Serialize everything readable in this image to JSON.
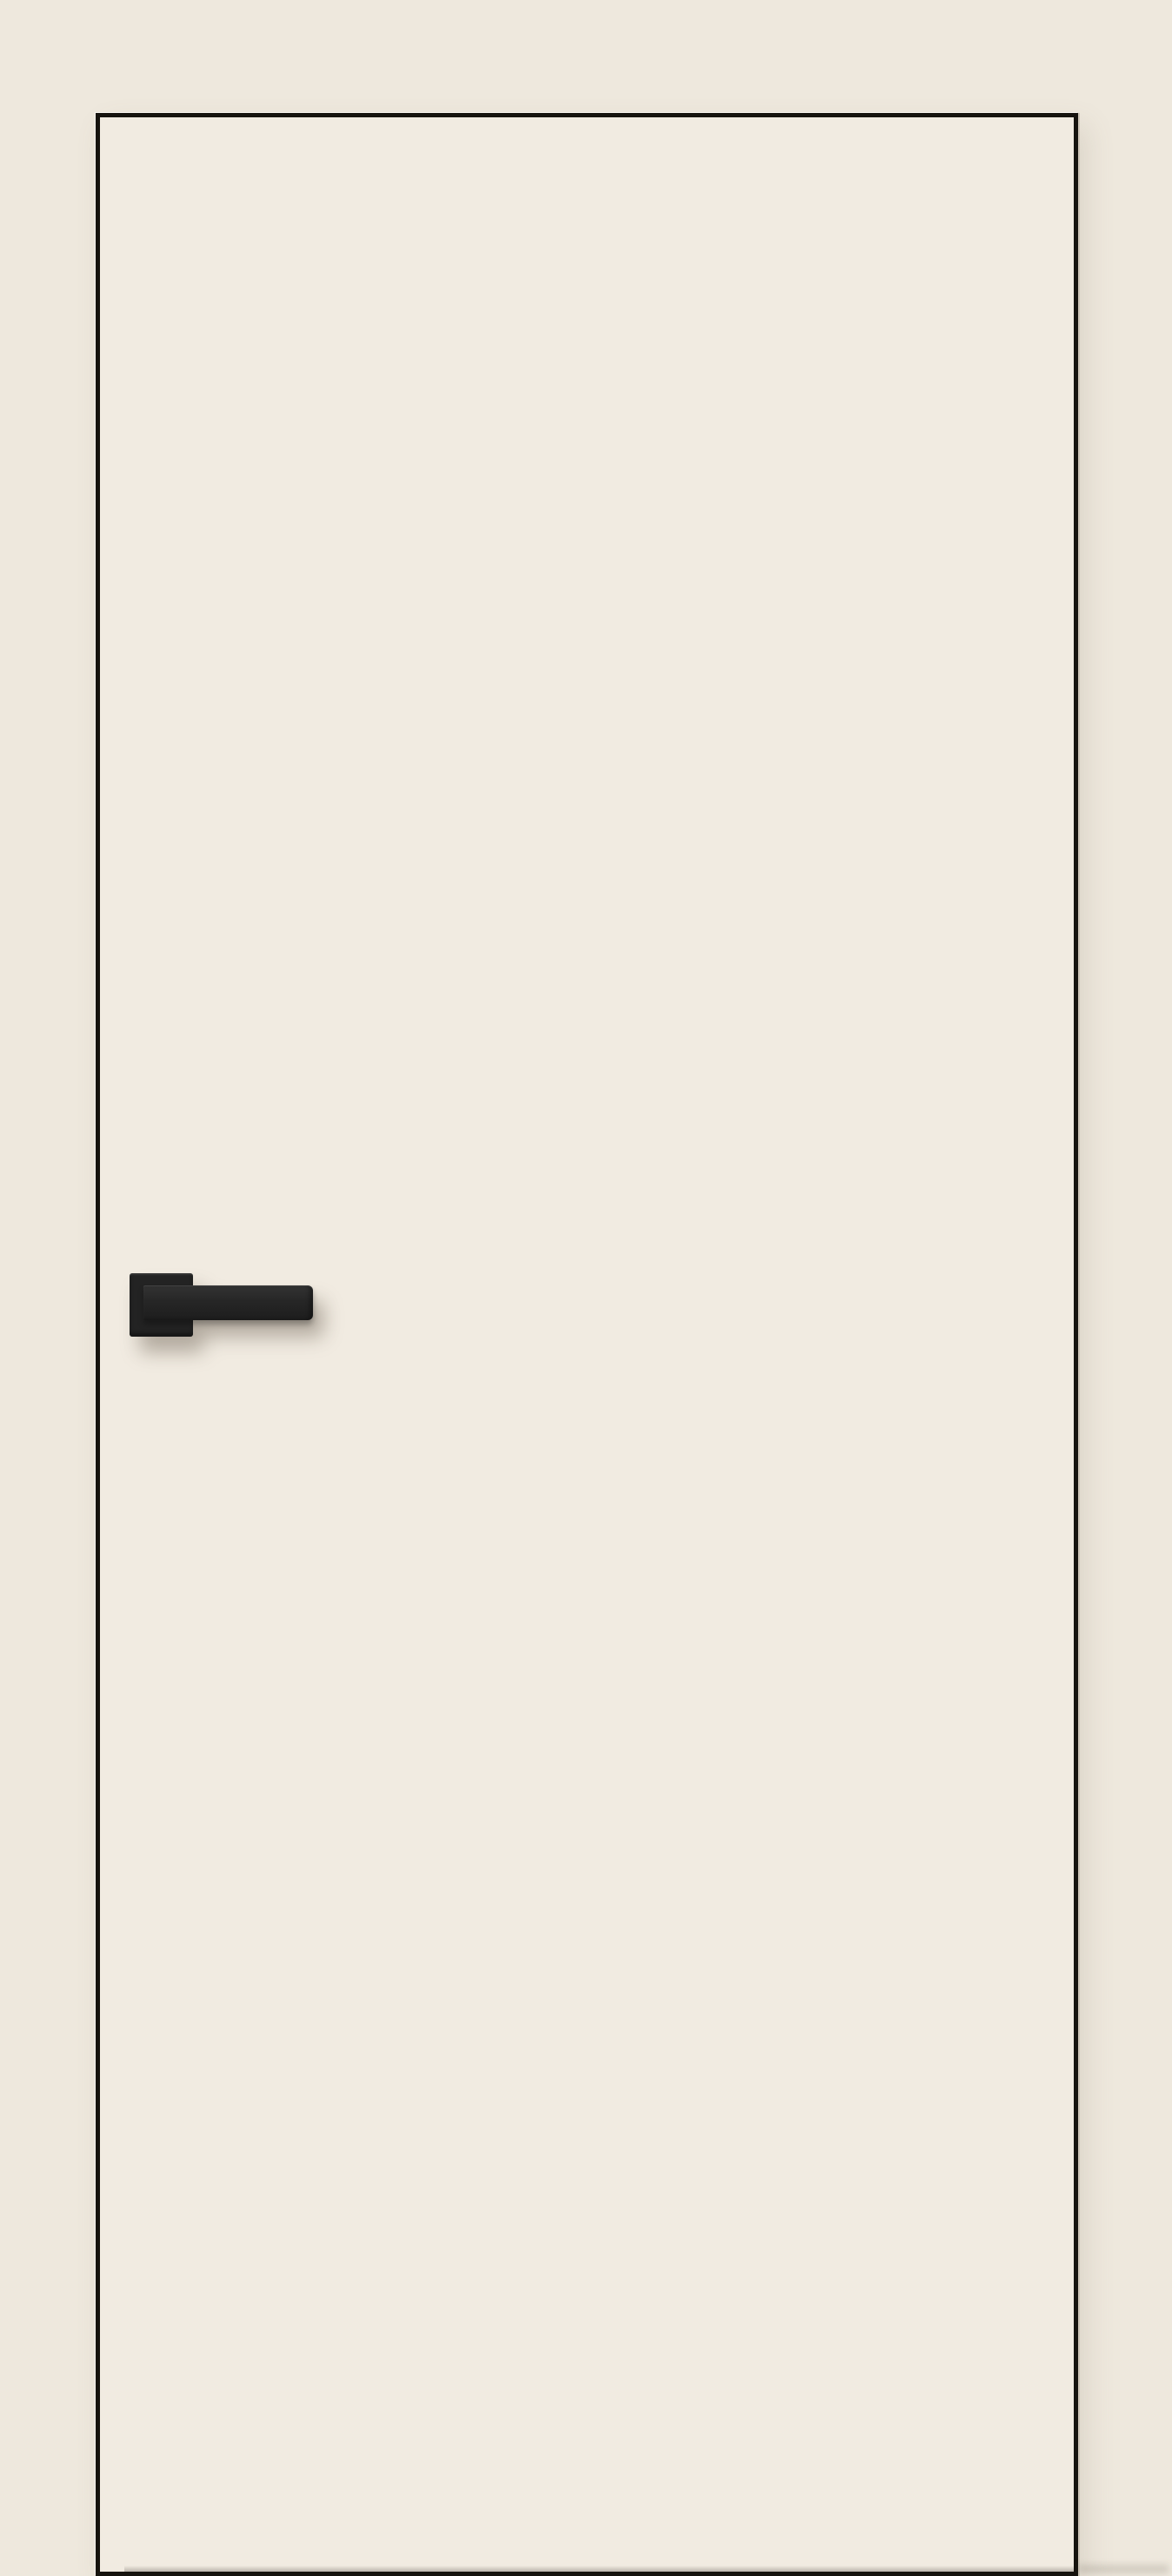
{
  "scene": {
    "description": "Product image of a flush modern interior door: cream painted slab with thin black edge trim, fitted with a matte black square-rosette lever handle on the left side, photographed straight-on against a cream wall"
  },
  "objects": {
    "door_panel": "plain flush door slab, no glazing, no panels, no hinges visible",
    "edge_trim": "thin dark aluminium-style trim outlining all four door edges",
    "handle_rosette": "square matte black rosette plate",
    "handle_lever": "straight rectangular matte black lever pointing right",
    "handle_shadow": "soft diffuse shadow cast down and to the right of the handle",
    "floor_shadow": "faint blurred shadow at floor level right of the door's bottom corner"
  },
  "colors": {
    "background": "#eee8dd",
    "door_face": "#f1ebe1",
    "edge_trim": "#16130e",
    "handle_base": "#232323",
    "handle_lever_top": "#333333",
    "handle_lever_bottom": "#1d1d1d",
    "shadow_soft": "rgba(104,94,79,0.45)",
    "bottom_shade": "rgba(60,55,48,0.30)"
  }
}
